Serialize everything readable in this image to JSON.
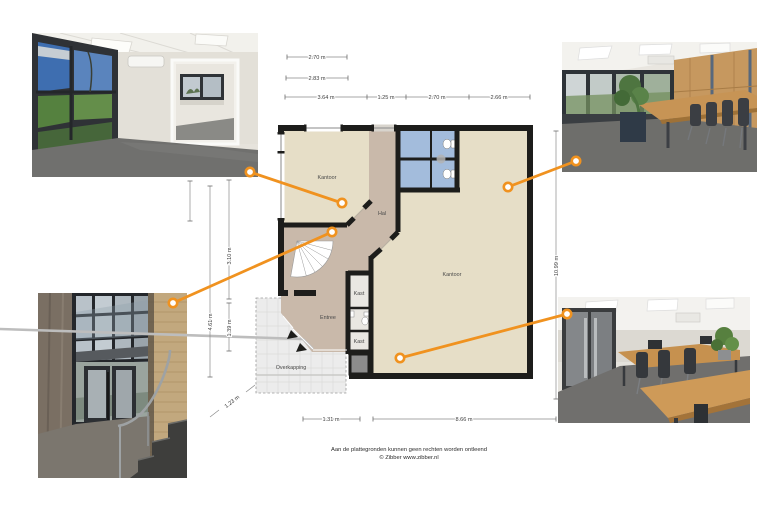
{
  "page": {
    "background": "#ffffff"
  },
  "branding": {
    "accent_orange": "#F0921F"
  },
  "floor_plan": {
    "labels": {
      "kantoor_small": "Kantoor",
      "hal": "Hal",
      "kantoor_large": "Kantoor",
      "entree": "Entree",
      "kast_top": "Kast",
      "kast_bottom": "Kast",
      "overkapping": "Overkapping"
    },
    "dimensions": {
      "top_w1": "2.70 m",
      "top_w2": "2.83 m",
      "seg_1": "3.64 m",
      "seg_2": "1.25 m",
      "seg_3": "2.70 m",
      "seg_4": "2.66 m",
      "left_1": "3.10 m",
      "left_2": "4.61 m",
      "left_3": "1.39 m",
      "right_1": "10.99 m",
      "bottom_1": "1.31 m",
      "bottom_2": "8.66 m",
      "diag_1": "1.23 m"
    },
    "colors": {
      "room_fill": "#E6DEC7",
      "hall_fill": "#C9B9AA",
      "wet_room_fill": "#A3BCDC",
      "storage_fill": "#E9E7E2",
      "wall": "#1D1D1B",
      "canopy_fill": "#ECECEC",
      "tech_square": "#8C8C8C"
    }
  },
  "photos": {
    "top_left": "office-with-window-wall",
    "top_right": "meeting-room",
    "bottom_left": "entrance-stairwell",
    "bottom_right": "open-office"
  },
  "footer": {
    "disclaimer": "Aan de plattegronden kunnen geen rechten worden ontleend",
    "credit": "© Zibber www.zibber.nl"
  }
}
